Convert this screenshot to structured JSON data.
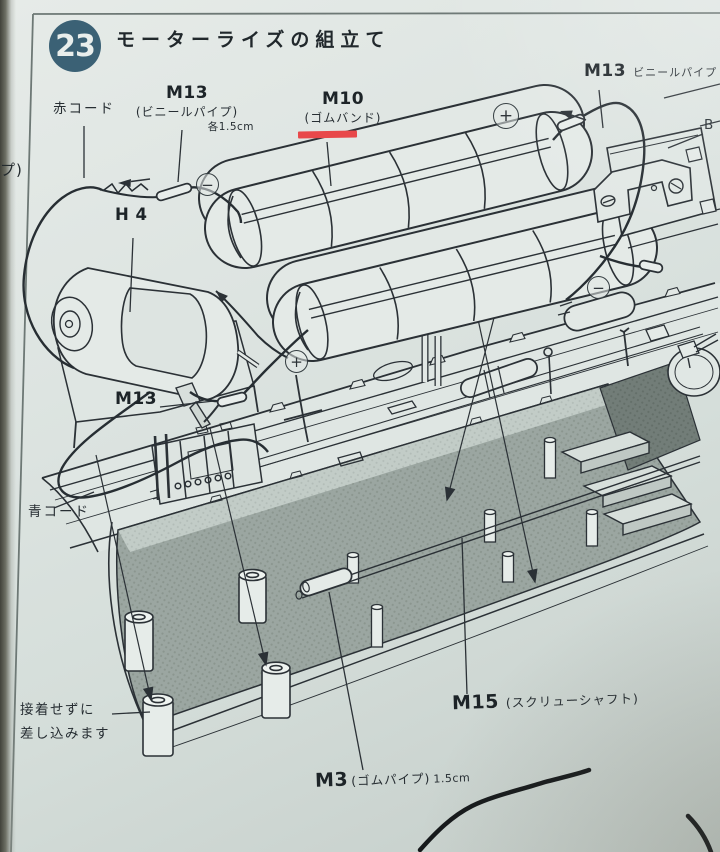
{
  "step": {
    "number": "23",
    "title": "モーターライズの組立て"
  },
  "parts": {
    "m13_top": {
      "code": "M13",
      "name": "ビニールパイプ"
    },
    "m13_left": {
      "code": "M13",
      "name": "(ビニールパイプ)",
      "note": "各1.5cm"
    },
    "m10": {
      "code": "M10",
      "name": "(ゴムバンド)"
    },
    "h4": {
      "code": "H 4"
    },
    "m13_mid": {
      "code": "M13"
    },
    "m15": {
      "code": "M15",
      "name": "(スクリューシャフト)"
    },
    "m3": {
      "code": "M3",
      "name": "(ゴムパイプ)",
      "note": "1.5cm"
    },
    "b_ref": {
      "code": "B"
    }
  },
  "notes": {
    "red_cord": "赤コード",
    "blue_cord": "青コード",
    "insert_line1": "接着せずに",
    "insert_line2": "差し込みます",
    "clipped_left": "プ)"
  },
  "polarity": {
    "plus": "+",
    "minus": "−"
  },
  "colors": {
    "badge_blue": "#3b6175",
    "underline_red": "#e8484a",
    "ink": "#2b3136",
    "deck_gray": "#9ba6a1"
  }
}
